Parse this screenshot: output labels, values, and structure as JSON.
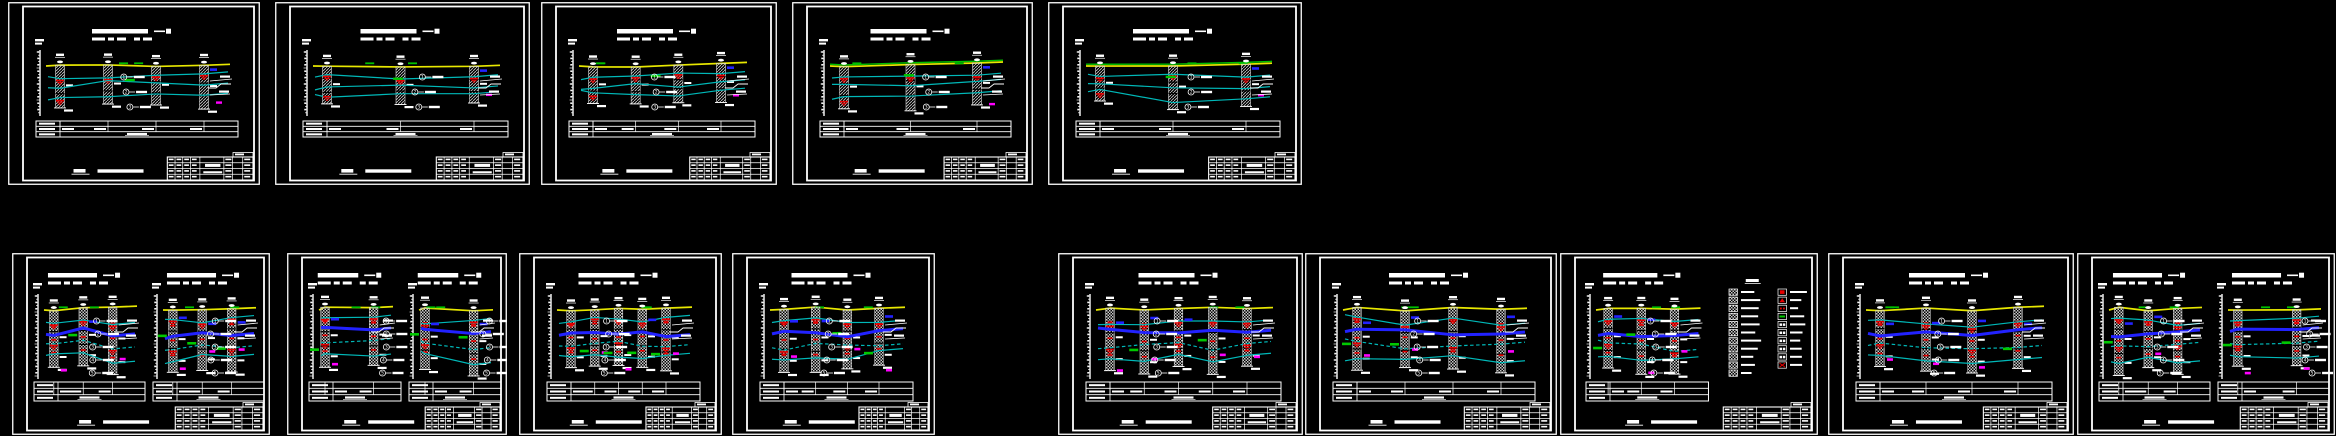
{
  "canvas": {
    "width": 2336,
    "height": 436,
    "background": "#000000"
  },
  "colors": {
    "frame": "#ffffff",
    "hatch": "#c8c8c8",
    "surface": "#e8e800",
    "surface_alt": "#00c000",
    "strata": "#00b8b8",
    "aquifer_band": "#2222ff",
    "water_marker": "#e80000",
    "marker_green": "#00c800",
    "marker_magenta": "#ff00ff",
    "marker_blue": "#2222ff"
  },
  "strata_labels": [
    "1",
    "2",
    "3",
    "4",
    "5",
    "6"
  ],
  "legend": {
    "left_items": 11,
    "right_kinds": [
      "red-fill",
      "red-tri",
      "red-dot",
      "green-bar",
      "letters",
      "letters",
      "letters",
      "letters",
      "letters",
      "red-cross"
    ]
  },
  "rows": [
    {
      "name": "top",
      "y": 2,
      "height": 183,
      "sheets": [
        {
          "id": "T1",
          "x": 8,
          "w": 252,
          "panels": [
            {
              "boreholes": 4
            }
          ],
          "green_surface": false,
          "legend": false
        },
        {
          "id": "T2",
          "x": 275,
          "w": 255,
          "panels": [
            {
              "boreholes": 3
            }
          ],
          "green_surface": false,
          "legend": false
        },
        {
          "id": "T3",
          "x": 541,
          "w": 236,
          "panels": [
            {
              "boreholes": 4
            }
          ],
          "green_surface": false,
          "legend": false
        },
        {
          "id": "T4",
          "x": 792,
          "w": 241,
          "panels": [
            {
              "boreholes": 3
            }
          ],
          "green_surface": true,
          "legend": false
        },
        {
          "id": "T5",
          "x": 1048,
          "w": 254,
          "panels": [
            {
              "boreholes": 3
            }
          ],
          "green_surface": true,
          "legend": false
        }
      ]
    },
    {
      "name": "bottom",
      "y": 253,
      "height": 182,
      "sheets": [
        {
          "id": "B1",
          "x": 12,
          "w": 258,
          "panels": [
            {
              "boreholes": 3
            },
            {
              "boreholes": 3
            }
          ],
          "green_surface": false,
          "legend": false
        },
        {
          "id": "B2",
          "x": 287,
          "w": 220,
          "panels": [
            {
              "boreholes": 2
            },
            {
              "boreholes": 2
            }
          ],
          "green_surface": false,
          "legend": false
        },
        {
          "id": "B3",
          "x": 519,
          "w": 203,
          "panels": [
            {
              "boreholes": 5
            }
          ],
          "green_surface": false,
          "legend": false
        },
        {
          "id": "B4",
          "x": 732,
          "w": 203,
          "panels": [
            {
              "boreholes": 4
            }
          ],
          "green_surface": false,
          "legend": false
        },
        {
          "id": "B5",
          "x": 1058,
          "w": 245,
          "panels": [
            {
              "boreholes": 5
            }
          ],
          "green_surface": false,
          "legend": false
        },
        {
          "id": "B6",
          "x": 1305,
          "w": 252,
          "panels": [
            {
              "boreholes": 4
            }
          ],
          "green_surface": false,
          "legend": false
        },
        {
          "id": "B7",
          "x": 1560,
          "w": 258,
          "panels": [
            {
              "boreholes": 3
            }
          ],
          "green_surface": false,
          "legend": true
        },
        {
          "id": "B8",
          "x": 1828,
          "w": 246,
          "panels": [
            {
              "boreholes": 4
            }
          ],
          "green_surface": false,
          "legend": false
        },
        {
          "id": "B9",
          "x": 2077,
          "w": 258,
          "panels": [
            {
              "boreholes": 3
            },
            {
              "boreholes": 2
            }
          ],
          "green_surface": false,
          "legend": false
        }
      ]
    }
  ]
}
